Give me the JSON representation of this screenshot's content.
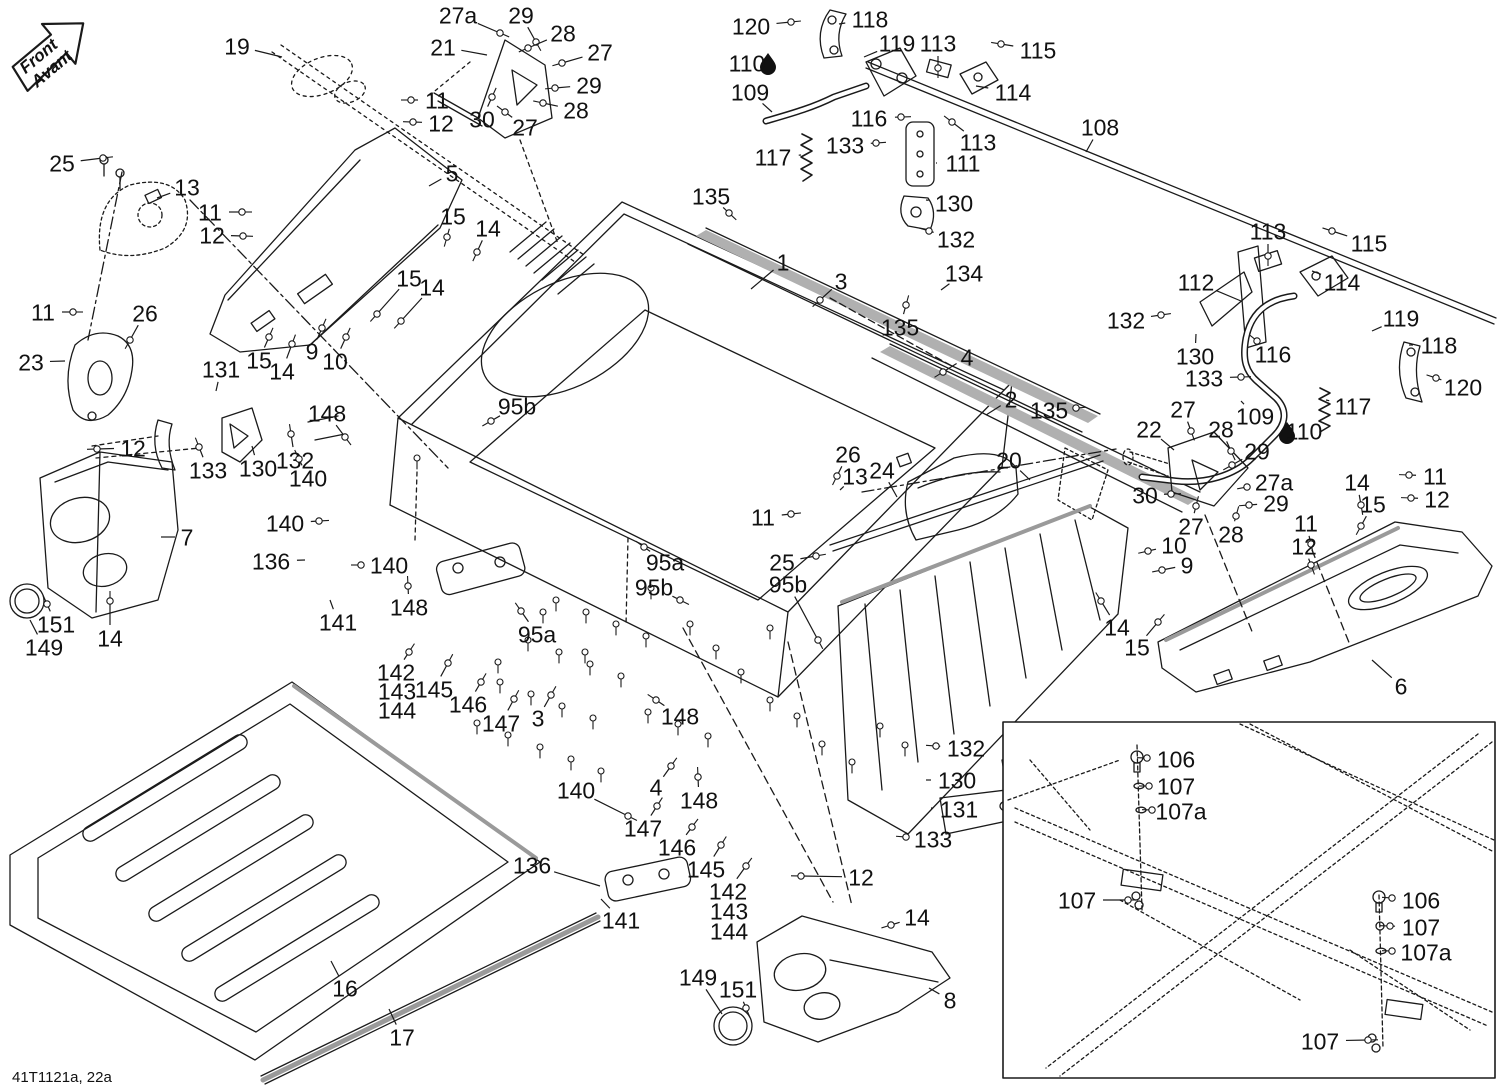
{
  "drawing_code": "41T1121a, 22a",
  "front_arrow": {
    "line1": "Front",
    "line2": "Avant"
  },
  "colors": {
    "line": "#1a1a1a",
    "accent": "#9a9a9a",
    "background": "#ffffff",
    "label_text": "#111111"
  },
  "droplet_icons": [
    {
      "x": 768,
      "y": 62
    },
    {
      "x": 1287,
      "y": 431
    }
  ],
  "fastener_parts": [
    "3",
    "4",
    "9",
    "10",
    "11",
    "12",
    "14",
    "15",
    "25",
    "26",
    "27",
    "27a",
    "28",
    "29",
    "30",
    "95a",
    "95b",
    "106",
    "107",
    "107a",
    "113",
    "115",
    "116",
    "120",
    "132",
    "133",
    "135",
    "140",
    "142",
    "143",
    "144",
    "145",
    "146",
    "147",
    "148",
    "151"
  ],
  "floor_bolts": [
    [
      556,
      600
    ],
    [
      586,
      612
    ],
    [
      616,
      624
    ],
    [
      646,
      636
    ],
    [
      528,
      640
    ],
    [
      559,
      652
    ],
    [
      590,
      664
    ],
    [
      621,
      676
    ],
    [
      500,
      682
    ],
    [
      531,
      694
    ],
    [
      562,
      706
    ],
    [
      593,
      718
    ],
    [
      477,
      723
    ],
    [
      508,
      735
    ],
    [
      540,
      747
    ],
    [
      571,
      759
    ],
    [
      601,
      771
    ],
    [
      648,
      712
    ],
    [
      678,
      724
    ],
    [
      708,
      736
    ],
    [
      690,
      624
    ],
    [
      716,
      648
    ],
    [
      741,
      672
    ],
    [
      770,
      700
    ],
    [
      797,
      716
    ],
    [
      822,
      744
    ],
    [
      852,
      762
    ],
    [
      880,
      726
    ],
    [
      905,
      745
    ],
    [
      417,
      458
    ],
    [
      651,
      588
    ],
    [
      543,
      612
    ],
    [
      585,
      652
    ],
    [
      498,
      662
    ],
    [
      770,
      628
    ]
  ],
  "callouts": [
    {
      "t": "19",
      "x": 237,
      "y": 46,
      "ex": 282,
      "ey": 57
    },
    {
      "t": "27a",
      "x": 458,
      "y": 15,
      "ex": 500,
      "ey": 33
    },
    {
      "t": "29",
      "x": 521,
      "y": 15,
      "ex": 536,
      "ey": 42
    },
    {
      "t": "28",
      "x": 563,
      "y": 33,
      "ex": 528,
      "ey": 48
    },
    {
      "t": "21",
      "x": 443,
      "y": 47,
      "ex": 487,
      "ey": 55
    },
    {
      "t": "27",
      "x": 600,
      "y": 52,
      "ex": 562,
      "ey": 63
    },
    {
      "t": "29",
      "x": 589,
      "y": 85,
      "ex": 555,
      "ey": 88
    },
    {
      "t": "28",
      "x": 576,
      "y": 110,
      "ex": 543,
      "ey": 103
    },
    {
      "t": "30",
      "x": 482,
      "y": 119,
      "ex": 492,
      "ey": 97
    },
    {
      "t": "27",
      "x": 525,
      "y": 127,
      "ex": 505,
      "ey": 112
    },
    {
      "t": "11",
      "x": 437,
      "y": 100,
      "ex": 411,
      "ey": 100
    },
    {
      "t": "12",
      "x": 441,
      "y": 123,
      "ex": 413,
      "ey": 122
    },
    {
      "t": "120",
      "x": 751,
      "y": 26,
      "ex": 791,
      "ey": 22
    },
    {
      "t": "118",
      "x": 870,
      "y": 19,
      "ex": 839,
      "ey": 24
    },
    {
      "t": "119",
      "x": 897,
      "y": 43,
      "ex": 864,
      "ey": 57
    },
    {
      "t": "113",
      "x": 938,
      "y": 43,
      "ex": 938,
      "ey": 68
    },
    {
      "t": "115",
      "x": 1038,
      "y": 50,
      "ex": 1001,
      "ey": 44
    },
    {
      "t": "110",
      "x": 747,
      "y": 63
    },
    {
      "t": "109",
      "x": 750,
      "y": 92,
      "ex": 772,
      "ey": 112
    },
    {
      "t": "114",
      "x": 1013,
      "y": 92,
      "ex": 976,
      "ey": 86
    },
    {
      "t": "116",
      "x": 869,
      "y": 118,
      "ex": 901,
      "ey": 117
    },
    {
      "t": "133",
      "x": 845,
      "y": 145,
      "ex": 876,
      "ey": 143
    },
    {
      "t": "113",
      "x": 978,
      "y": 142,
      "ex": 952,
      "ey": 122
    },
    {
      "t": "111",
      "x": 963,
      "y": 163,
      "ex": 936,
      "ey": 163
    },
    {
      "t": "117",
      "x": 773,
      "y": 157,
      "ex": 801,
      "ey": 155
    },
    {
      "t": "108",
      "x": 1100,
      "y": 127,
      "ex": 1086,
      "ey": 152
    },
    {
      "t": "113",
      "x": 1268,
      "y": 231,
      "ex": 1268,
      "ey": 256
    },
    {
      "t": "115",
      "x": 1369,
      "y": 243,
      "ex": 1332,
      "ey": 231
    },
    {
      "t": "112",
      "x": 1196,
      "y": 282,
      "ex": 1241,
      "ey": 301
    },
    {
      "t": "114",
      "x": 1342,
      "y": 282,
      "ex": 1312,
      "ey": 271
    },
    {
      "t": "132",
      "x": 1126,
      "y": 320,
      "ex": 1161,
      "ey": 315
    },
    {
      "t": "119",
      "x": 1401,
      "y": 318,
      "ex": 1372,
      "ey": 331
    },
    {
      "t": "118",
      "x": 1439,
      "y": 345,
      "ex": 1409,
      "ey": 345
    },
    {
      "t": "130",
      "x": 1195,
      "y": 356,
      "ex": 1196,
      "ey": 334
    },
    {
      "t": "116",
      "x": 1273,
      "y": 354,
      "ex": 1257,
      "ey": 341
    },
    {
      "t": "133",
      "x": 1204,
      "y": 378,
      "ex": 1241,
      "ey": 377
    },
    {
      "t": "120",
      "x": 1463,
      "y": 387,
      "ex": 1436,
      "ey": 378
    },
    {
      "t": "109",
      "x": 1255,
      "y": 416,
      "ex": 1241,
      "ey": 401
    },
    {
      "t": "117",
      "x": 1353,
      "y": 406,
      "ex": 1326,
      "ey": 400
    },
    {
      "t": "110",
      "x": 1304,
      "y": 431
    },
    {
      "t": "22",
      "x": 1149,
      "y": 429,
      "ex": 1174,
      "ey": 450
    },
    {
      "t": "27",
      "x": 1183,
      "y": 409,
      "ex": 1191,
      "ey": 431
    },
    {
      "t": "28",
      "x": 1221,
      "y": 429,
      "ex": 1231,
      "ey": 451
    },
    {
      "t": "29",
      "x": 1257,
      "y": 451,
      "ex": 1232,
      "ey": 465
    },
    {
      "t": "27a",
      "x": 1274,
      "y": 482,
      "ex": 1247,
      "ey": 487
    },
    {
      "t": "30",
      "x": 1145,
      "y": 495,
      "ex": 1171,
      "ey": 494
    },
    {
      "t": "29",
      "x": 1276,
      "y": 503,
      "ex": 1249,
      "ey": 505
    },
    {
      "t": "27",
      "x": 1191,
      "y": 526,
      "ex": 1196,
      "ey": 506
    },
    {
      "t": "28",
      "x": 1231,
      "y": 534,
      "ex": 1236,
      "ey": 516
    },
    {
      "t": "14",
      "x": 1357,
      "y": 482,
      "ex": 1361,
      "ey": 505
    },
    {
      "t": "11",
      "x": 1435,
      "y": 476,
      "ex": 1409,
      "ey": 475
    },
    {
      "t": "15",
      "x": 1373,
      "y": 504,
      "ex": 1361,
      "ey": 526
    },
    {
      "t": "12",
      "x": 1437,
      "y": 499,
      "ex": 1411,
      "ey": 498
    },
    {
      "t": "11",
      "x": 1306,
      "y": 523,
      "ex": 1311,
      "ey": 544
    },
    {
      "t": "12",
      "x": 1304,
      "y": 546,
      "ex": 1311,
      "ey": 565
    },
    {
      "t": "10",
      "x": 1174,
      "y": 545,
      "ex": 1148,
      "ey": 551
    },
    {
      "t": "9",
      "x": 1187,
      "y": 565,
      "ex": 1162,
      "ey": 570
    },
    {
      "t": "14",
      "x": 1117,
      "y": 627,
      "ex": 1101,
      "ey": 601
    },
    {
      "t": "15",
      "x": 1137,
      "y": 647,
      "ex": 1158,
      "ey": 622
    },
    {
      "t": "6",
      "x": 1401,
      "y": 686,
      "ex": 1372,
      "ey": 660
    },
    {
      "t": "25",
      "x": 62,
      "y": 163,
      "ex": 103,
      "ey": 158
    },
    {
      "t": "13",
      "x": 187,
      "y": 187,
      "ex": 157,
      "ey": 198
    },
    {
      "t": "11",
      "x": 210,
      "y": 212,
      "ex": 242,
      "ey": 212
    },
    {
      "t": "12",
      "x": 212,
      "y": 235,
      "ex": 243,
      "ey": 236
    },
    {
      "t": "5",
      "x": 452,
      "y": 173,
      "ex": 429,
      "ey": 186
    },
    {
      "t": "15",
      "x": 453,
      "y": 216,
      "ex": 447,
      "ey": 237
    },
    {
      "t": "14",
      "x": 488,
      "y": 228,
      "ex": 477,
      "ey": 252
    },
    {
      "t": "15",
      "x": 409,
      "y": 278,
      "ex": 377,
      "ey": 314
    },
    {
      "t": "14",
      "x": 432,
      "y": 287,
      "ex": 401,
      "ey": 321
    },
    {
      "t": "11",
      "x": 43,
      "y": 312,
      "ex": 73,
      "ey": 312
    },
    {
      "t": "26",
      "x": 145,
      "y": 313,
      "ex": 130,
      "ey": 340
    },
    {
      "t": "23",
      "x": 31,
      "y": 362,
      "ex": 65,
      "ey": 361
    },
    {
      "t": "15",
      "x": 259,
      "y": 360,
      "ex": 269,
      "ey": 337
    },
    {
      "t": "14",
      "x": 282,
      "y": 371,
      "ex": 292,
      "ey": 344
    },
    {
      "t": "9",
      "x": 312,
      "y": 351,
      "ex": 322,
      "ey": 328
    },
    {
      "t": "10",
      "x": 335,
      "y": 361,
      "ex": 346,
      "ey": 337
    },
    {
      "t": "131",
      "x": 221,
      "y": 369,
      "ex": 216,
      "ey": 391
    },
    {
      "t": "148",
      "x": 327,
      "y": 413,
      "ex": 345,
      "ey": 437
    },
    {
      "t": "133",
      "x": 208,
      "y": 470,
      "ex": 199,
      "ey": 447
    },
    {
      "t": "130",
      "x": 258,
      "y": 468,
      "ex": 252,
      "ey": 446
    },
    {
      "t": "132",
      "x": 295,
      "y": 460,
      "ex": 291,
      "ey": 434
    },
    {
      "t": "140",
      "x": 308,
      "y": 478,
      "ex": 299,
      "ey": 459
    },
    {
      "t": "12",
      "x": 133,
      "y": 448,
      "ex": 97,
      "ey": 449
    },
    {
      "t": "7",
      "x": 187,
      "y": 537,
      "ex": 161,
      "ey": 537
    },
    {
      "t": "140",
      "x": 285,
      "y": 523,
      "ex": 319,
      "ey": 521
    },
    {
      "t": "136",
      "x": 271,
      "y": 561,
      "ex": 305,
      "ey": 560
    },
    {
      "t": "140",
      "x": 389,
      "y": 565,
      "ex": 361,
      "ey": 565
    },
    {
      "t": "141",
      "x": 338,
      "y": 622,
      "ex": 330,
      "ey": 600
    },
    {
      "t": "148",
      "x": 409,
      "y": 607,
      "ex": 408,
      "ey": 586
    },
    {
      "t": "151",
      "x": 56,
      "y": 624,
      "ex": 47,
      "ey": 604
    },
    {
      "t": "149",
      "x": 44,
      "y": 647,
      "ex": 30,
      "ey": 620
    },
    {
      "t": "14",
      "x": 110,
      "y": 638,
      "ex": 110,
      "ey": 601
    },
    {
      "t": "135",
      "x": 711,
      "y": 196,
      "ex": 729,
      "ey": 213
    },
    {
      "t": "1",
      "x": 783,
      "y": 262,
      "ex": 751,
      "ey": 289
    },
    {
      "t": "3",
      "x": 841,
      "y": 281,
      "ex": 820,
      "ey": 300
    },
    {
      "t": "130",
      "x": 954,
      "y": 203,
      "ex": 926,
      "ey": 200
    },
    {
      "t": "132",
      "x": 956,
      "y": 239,
      "ex": 929,
      "ey": 231
    },
    {
      "t": "134",
      "x": 964,
      "y": 273,
      "ex": 941,
      "ey": 290
    },
    {
      "t": "135",
      "x": 900,
      "y": 327,
      "ex": 906,
      "ey": 305
    },
    {
      "t": "4",
      "x": 967,
      "y": 357,
      "ex": 943,
      "ey": 372
    },
    {
      "t": "2",
      "x": 1011,
      "y": 399,
      "ex": 986,
      "ey": 415
    },
    {
      "t": "135",
      "x": 1049,
      "y": 410,
      "ex": 1076,
      "ey": 408
    },
    {
      "t": "20",
      "x": 1009,
      "y": 460,
      "ex": 1030,
      "ey": 480
    },
    {
      "t": "95b",
      "x": 517,
      "y": 406,
      "ex": 491,
      "ey": 421
    },
    {
      "t": "26",
      "x": 848,
      "y": 454,
      "ex": 837,
      "ey": 476
    },
    {
      "t": "13",
      "x": 855,
      "y": 476,
      "ex": 840,
      "ey": 490
    },
    {
      "t": "24",
      "x": 882,
      "y": 470,
      "ex": 897,
      "ey": 497
    },
    {
      "t": "11",
      "x": 763,
      "y": 517,
      "ex": 791,
      "ey": 514
    },
    {
      "t": "95a",
      "x": 665,
      "y": 562,
      "ex": 644,
      "ey": 547
    },
    {
      "t": "25",
      "x": 782,
      "y": 562,
      "ex": 816,
      "ey": 556
    },
    {
      "t": "95b",
      "x": 654,
      "y": 587,
      "ex": 680,
      "ey": 600
    },
    {
      "t": "95b",
      "x": 788,
      "y": 584,
      "ex": 818,
      "ey": 640
    },
    {
      "t": "95a",
      "x": 537,
      "y": 634,
      "ex": 521,
      "ey": 611
    },
    {
      "t": "142",
      "x": 396,
      "y": 672,
      "ex": 409,
      "ey": 652
    },
    {
      "t": "143",
      "x": 397,
      "y": 691
    },
    {
      "t": "144",
      "x": 397,
      "y": 710
    },
    {
      "t": "145",
      "x": 434,
      "y": 689,
      "ex": 448,
      "ey": 663
    },
    {
      "t": "146",
      "x": 468,
      "y": 704,
      "ex": 481,
      "ey": 682
    },
    {
      "t": "147",
      "x": 501,
      "y": 723,
      "ex": 514,
      "ey": 699
    },
    {
      "t": "3",
      "x": 538,
      "y": 718,
      "ex": 551,
      "ey": 695
    },
    {
      "t": "148",
      "x": 680,
      "y": 716,
      "ex": 656,
      "ey": 700
    },
    {
      "t": "4",
      "x": 656,
      "y": 787,
      "ex": 671,
      "ey": 766
    },
    {
      "t": "140",
      "x": 576,
      "y": 790,
      "ex": 628,
      "ey": 816
    },
    {
      "t": "147",
      "x": 643,
      "y": 828,
      "ex": 657,
      "ey": 806
    },
    {
      "t": "146",
      "x": 677,
      "y": 847,
      "ex": 692,
      "ey": 827
    },
    {
      "t": "145",
      "x": 706,
      "y": 869,
      "ex": 721,
      "ey": 845
    },
    {
      "t": "136",
      "x": 532,
      "y": 865,
      "ex": 600,
      "ey": 886
    },
    {
      "t": "141",
      "x": 621,
      "y": 920,
      "ex": 601,
      "ey": 899
    },
    {
      "t": "142",
      "x": 728,
      "y": 891,
      "ex": 746,
      "ey": 866
    },
    {
      "t": "143",
      "x": 729,
      "y": 911
    },
    {
      "t": "144",
      "x": 729,
      "y": 931
    },
    {
      "t": "12",
      "x": 861,
      "y": 877,
      "ex": 801,
      "ey": 876
    },
    {
      "t": "14",
      "x": 917,
      "y": 917,
      "ex": 891,
      "ey": 925
    },
    {
      "t": "148",
      "x": 699,
      "y": 800,
      "ex": 698,
      "ey": 777
    },
    {
      "t": "132",
      "x": 966,
      "y": 748,
      "ex": 936,
      "ey": 746
    },
    {
      "t": "130",
      "x": 957,
      "y": 780,
      "ex": 926,
      "ey": 780
    },
    {
      "t": "131",
      "x": 959,
      "y": 809,
      "ex": 931,
      "ey": 808
    },
    {
      "t": "133",
      "x": 933,
      "y": 839,
      "ex": 906,
      "ey": 837
    },
    {
      "t": "149",
      "x": 698,
      "y": 977,
      "ex": 722,
      "ey": 1014
    },
    {
      "t": "151",
      "x": 738,
      "y": 989,
      "ex": 746,
      "ey": 1008
    },
    {
      "t": "8",
      "x": 950,
      "y": 1000,
      "ex": 929,
      "ey": 988
    },
    {
      "t": "16",
      "x": 345,
      "y": 988,
      "ex": 331,
      "ey": 961
    },
    {
      "t": "17",
      "x": 402,
      "y": 1037,
      "ex": 389,
      "ey": 1009
    },
    {
      "t": "106",
      "x": 1176,
      "y": 759,
      "ex": 1147,
      "ey": 758
    },
    {
      "t": "107",
      "x": 1176,
      "y": 786,
      "ex": 1149,
      "ey": 786
    },
    {
      "t": "107a",
      "x": 1181,
      "y": 811,
      "ex": 1152,
      "ey": 810
    },
    {
      "t": "107",
      "x": 1077,
      "y": 900,
      "ex": 1128,
      "ey": 900
    },
    {
      "t": "106",
      "x": 1421,
      "y": 900,
      "ex": 1392,
      "ey": 898
    },
    {
      "t": "107",
      "x": 1421,
      "y": 927,
      "ex": 1390,
      "ey": 926
    },
    {
      "t": "107a",
      "x": 1426,
      "y": 952,
      "ex": 1392,
      "ey": 951
    },
    {
      "t": "107",
      "x": 1320,
      "y": 1041,
      "ex": 1368,
      "ey": 1040
    }
  ]
}
